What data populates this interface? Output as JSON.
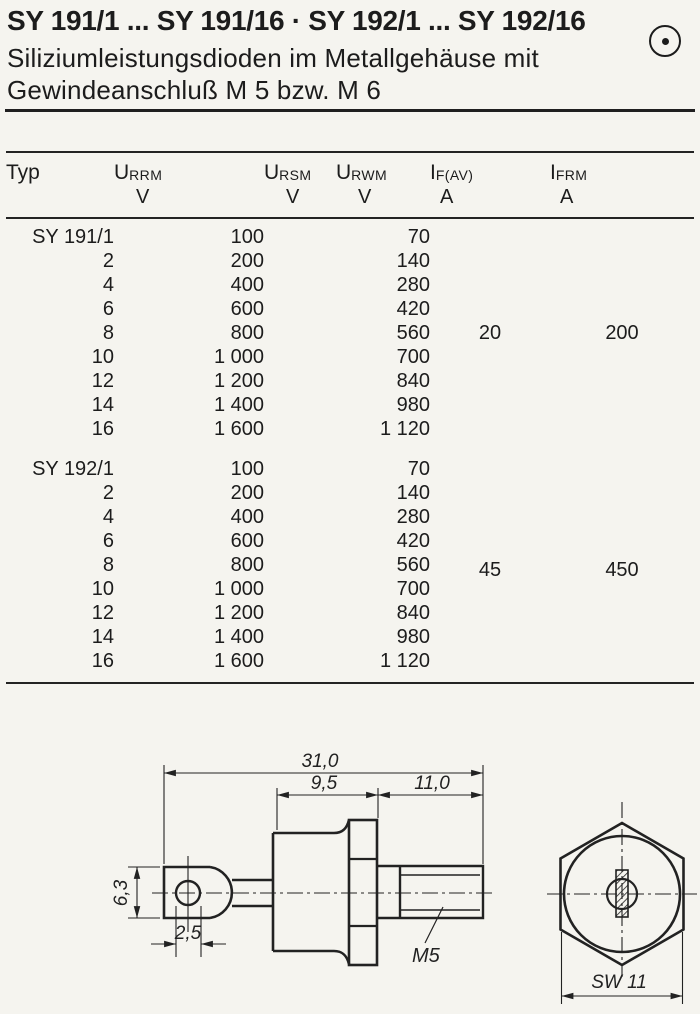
{
  "page": {
    "title": "SY 191/1 ... SY 191/16 · SY 192/1 ... SY 192/16",
    "subtitle_line1": "Siliziumleistungsdioden im Metallgehäuse mit",
    "subtitle_line2": "Gewindeanschluß M 5 bzw. M 6",
    "corner_icon": "circled-dot"
  },
  "table": {
    "columns": [
      {
        "name": "Typ",
        "sub": "",
        "unit": ""
      },
      {
        "name": "U",
        "sub": "RRM",
        "unit": "V"
      },
      {
        "name": "U",
        "sub": "RSM",
        "unit": "V"
      },
      {
        "name": "U",
        "sub": "RWM",
        "unit": "V"
      },
      {
        "name": "I",
        "sub": "F(AV)",
        "unit": "A"
      },
      {
        "name": "I",
        "sub": "FRM",
        "unit": "A"
      }
    ],
    "groups": [
      {
        "if_av": "20",
        "ifrm": "200",
        "rows": [
          {
            "typ": "SY 191/1",
            "urrm": "100",
            "ursm": "",
            "urwm": "70"
          },
          {
            "typ": "2",
            "urrm": "200",
            "ursm": "",
            "urwm": "140"
          },
          {
            "typ": "4",
            "urrm": "400",
            "ursm": "",
            "urwm": "280"
          },
          {
            "typ": "6",
            "urrm": "600",
            "ursm": "",
            "urwm": "420"
          },
          {
            "typ": "8",
            "urrm": "800",
            "ursm": "",
            "urwm": "560"
          },
          {
            "typ": "10",
            "urrm": "1 000",
            "ursm": "",
            "urwm": "700"
          },
          {
            "typ": "12",
            "urrm": "1 200",
            "ursm": "",
            "urwm": "840"
          },
          {
            "typ": "14",
            "urrm": "1 400",
            "ursm": "",
            "urwm": "980"
          },
          {
            "typ": "16",
            "urrm": "1 600",
            "ursm": "",
            "urwm": "1 120"
          }
        ]
      },
      {
        "if_av": "45",
        "ifrm": "450",
        "rows": [
          {
            "typ": "SY 192/1",
            "urrm": "100",
            "ursm": "",
            "urwm": "70"
          },
          {
            "typ": "2",
            "urrm": "200",
            "ursm": "",
            "urwm": "140"
          },
          {
            "typ": "4",
            "urrm": "400",
            "ursm": "",
            "urwm": "280"
          },
          {
            "typ": "6",
            "urrm": "600",
            "ursm": "",
            "urwm": "420"
          },
          {
            "typ": "8",
            "urrm": "800",
            "ursm": "",
            "urwm": "560"
          },
          {
            "typ": "10",
            "urrm": "1 000",
            "ursm": "",
            "urwm": "700"
          },
          {
            "typ": "12",
            "urrm": "1 200",
            "ursm": "",
            "urwm": "840"
          },
          {
            "typ": "14",
            "urrm": "1 400",
            "ursm": "",
            "urwm": "980"
          },
          {
            "typ": "16",
            "urrm": "1 600",
            "ursm": "",
            "urwm": "1 120"
          }
        ]
      }
    ]
  },
  "drawing": {
    "dim_total_length": "31,0",
    "dim_body_length": "9,5",
    "dim_stud_length": "11,0",
    "dim_lug_width": "6,3",
    "dim_hole": "2,5",
    "thread_label": "M5",
    "wrench_size_label": "SW 11"
  }
}
